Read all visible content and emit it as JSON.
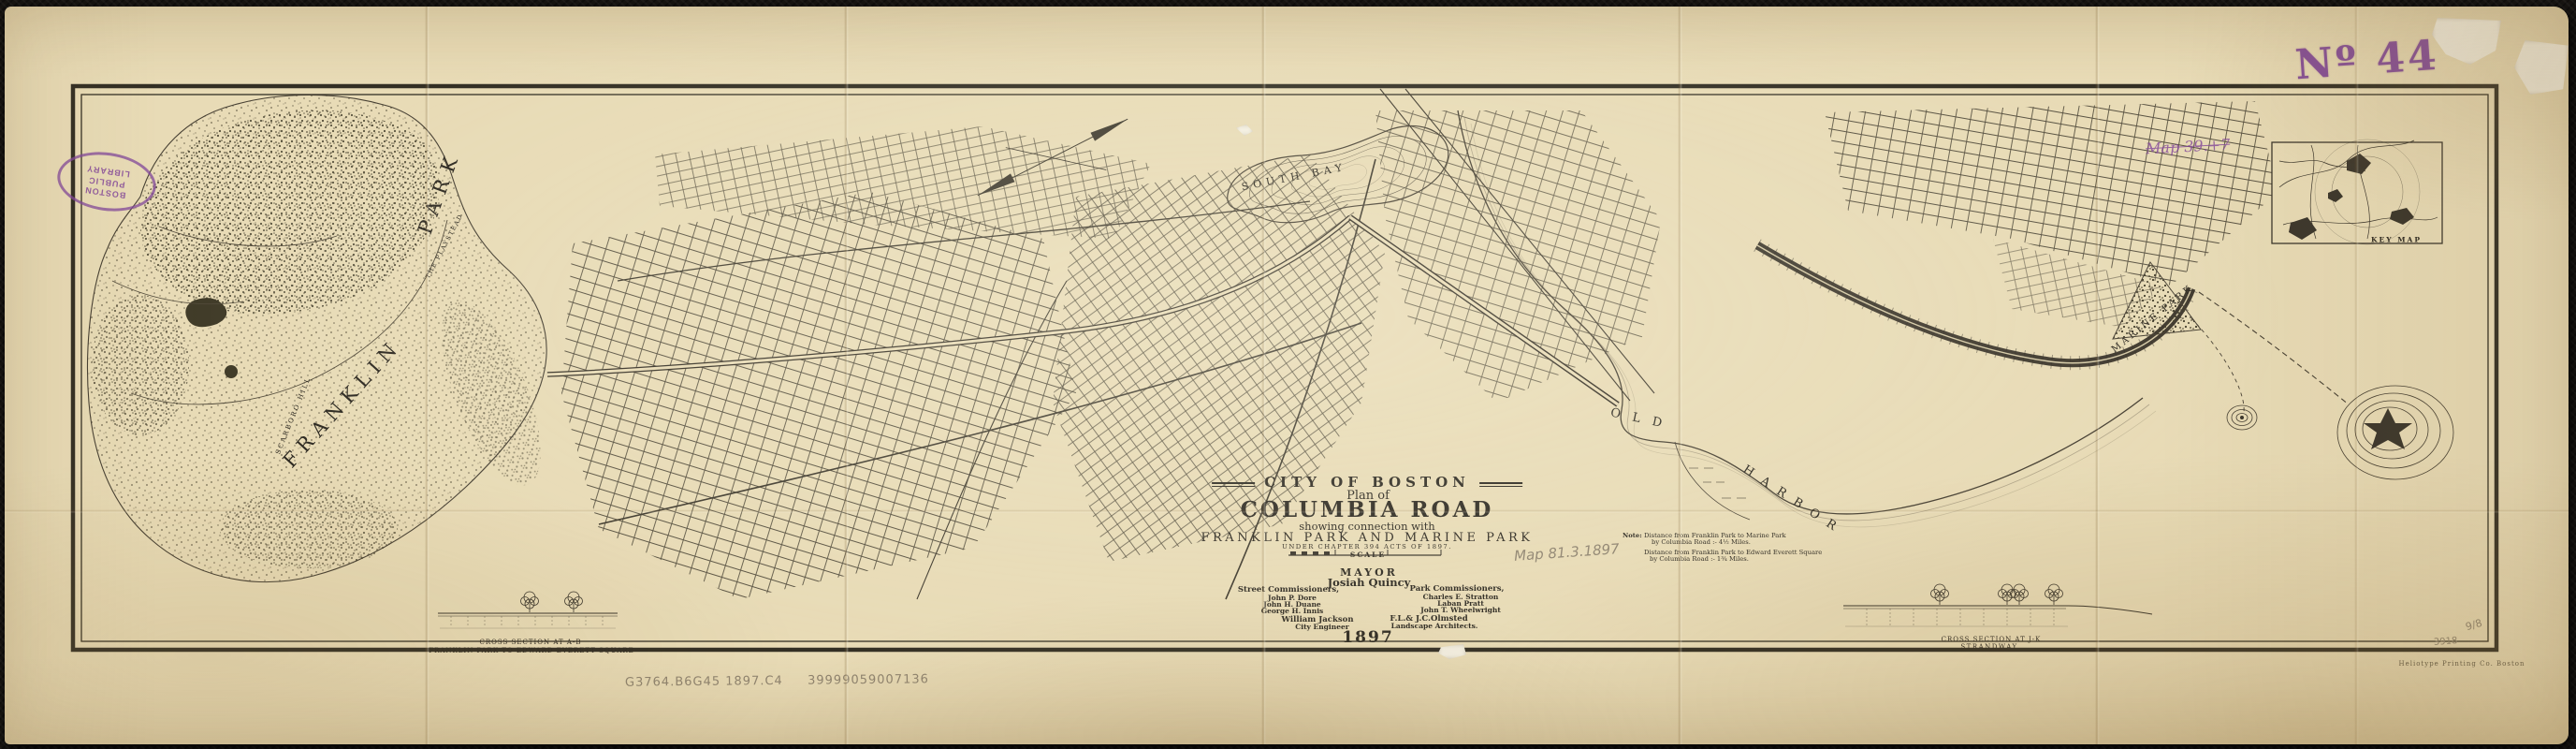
{
  "stamps": {
    "accession_number": "Nº 44",
    "library_stamp": "BOSTON PUBLIC LIBRARY",
    "purple_note": "Map 39.+7",
    "pencil_map_note": "Map 81.3.1897",
    "call_number": "G3764.B6G45 1897.C4",
    "barcode": "39999059007136",
    "pencil_mark_a": "9/8",
    "pencil_mark_b": "3918"
  },
  "imprint": "Heliotype Printing Co. Boston",
  "title_block": {
    "city": "CITY OF BOSTON",
    "plan_of": "Plan of",
    "title": "COLUMBIA ROAD",
    "subtitle": "showing connection with",
    "parks_line": "FRANKLIN PARK AND MARINE PARK",
    "chapter_line": "UNDER CHAPTER 394 ACTS OF 1897.",
    "scale_label": "SCALE",
    "mayor_label": "MAYOR",
    "mayor_name": "Josiah Quincy",
    "street_commissioners_label": "Street Commissioners,",
    "street_commissioners": [
      "John P. Dore",
      "John H. Duane",
      "George H. Innis"
    ],
    "park_commissioners_label": "Park Commissioners,",
    "park_commissioners": [
      "Charles E. Stratton",
      "Laban Pratt",
      "John T. Wheelwright"
    ],
    "engineer_name": "William Jackson",
    "engineer_title": "City Engineer",
    "landscape_name": "F.L.& J.C.Olmsted",
    "landscape_title": "Landscape Architects.",
    "year": "1897"
  },
  "notes": {
    "label": "Note:",
    "line1a": "Distance from Franklin Park to Marine Park",
    "line1b": "by Columbia Road :- 4½ Miles.",
    "line2a": "Distance from Franklin Park to Edward Everett Square",
    "line2b": "by Columbia Road :- 1¾ Miles."
  },
  "map_labels": {
    "franklin": "FRANKLIN",
    "park": "PARK",
    "scarboro_hill": "SCARBORO HILL",
    "playstead": "THE PLAYSTEAD",
    "south_bay": "SOUTH BAY",
    "old": "OLD",
    "harbor": "HARBOR",
    "marine_park": "MARINE PARK",
    "key_map": "KEY MAP"
  },
  "cross_sections": {
    "left_title": "CROSS SECTION AT A-B",
    "left_subtitle": "FRANKLIN PARK TO EDWARD EVERETT SQUARE",
    "right_title": "CROSS SECTION AT J-K",
    "right_subtitle": "STRANDWAY"
  },
  "colors": {
    "paper": "#e8dbb6",
    "ink": "#2e2a22",
    "stamp_purple": "#82479a",
    "pencil": "#8f8470"
  }
}
